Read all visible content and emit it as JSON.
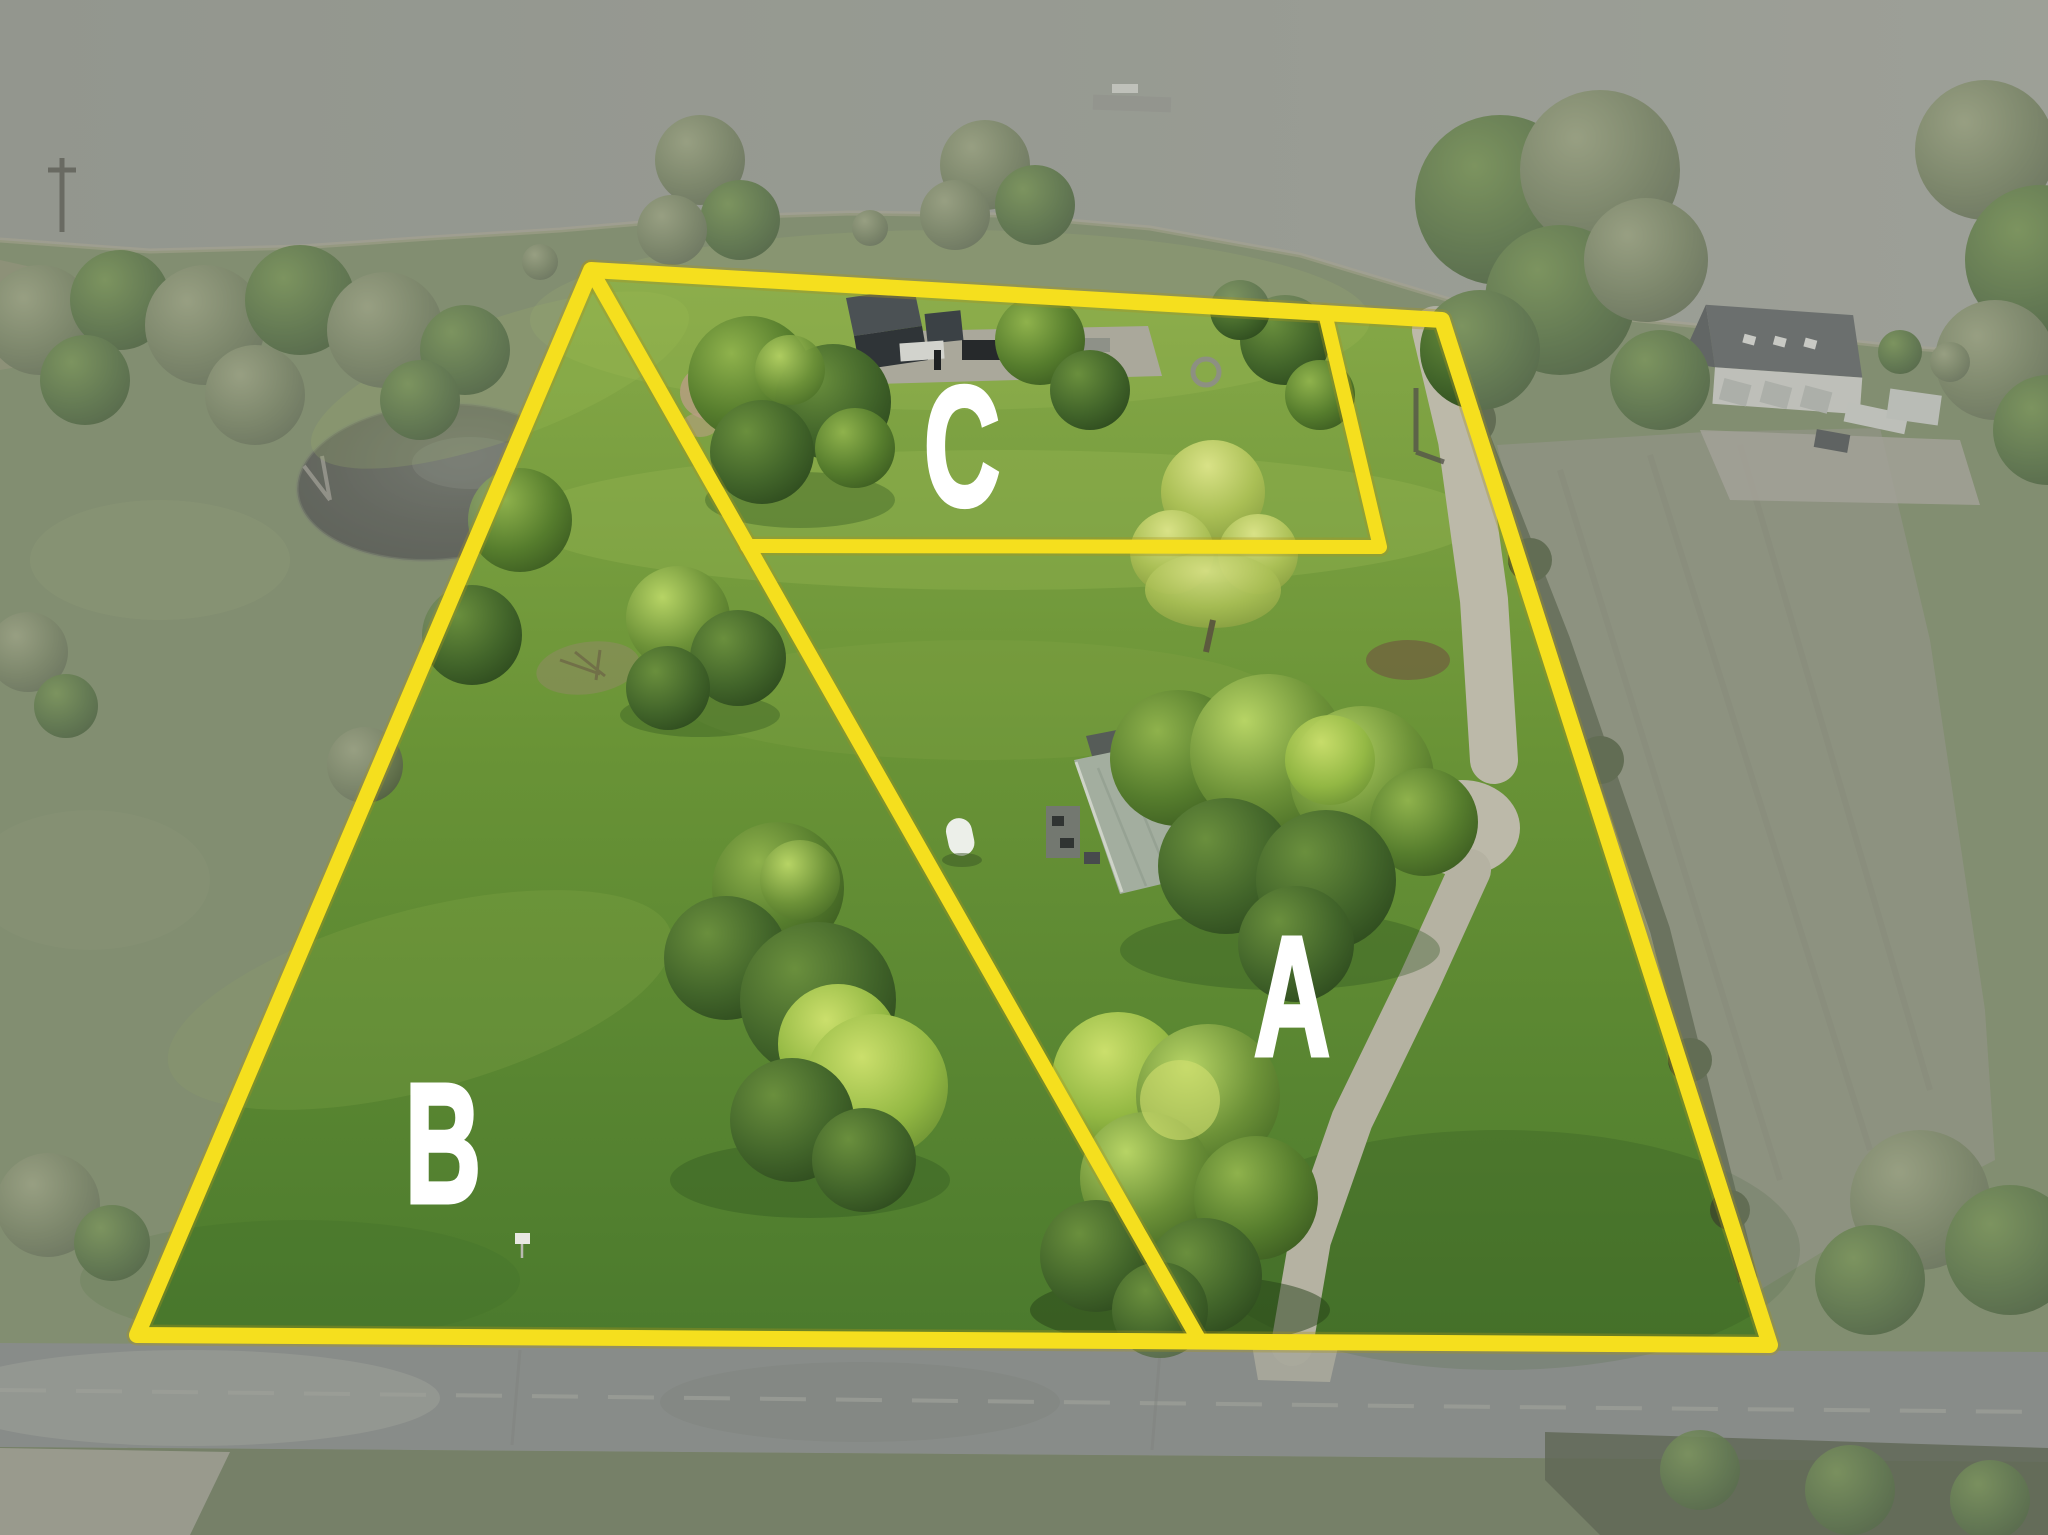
{
  "labels": {
    "parcel_a": "A",
    "parcel_b": "B",
    "parcel_c": "C"
  },
  "colors": {
    "boundary_line": "#F5DF1E",
    "parcel_label": "#FFFFFF"
  }
}
